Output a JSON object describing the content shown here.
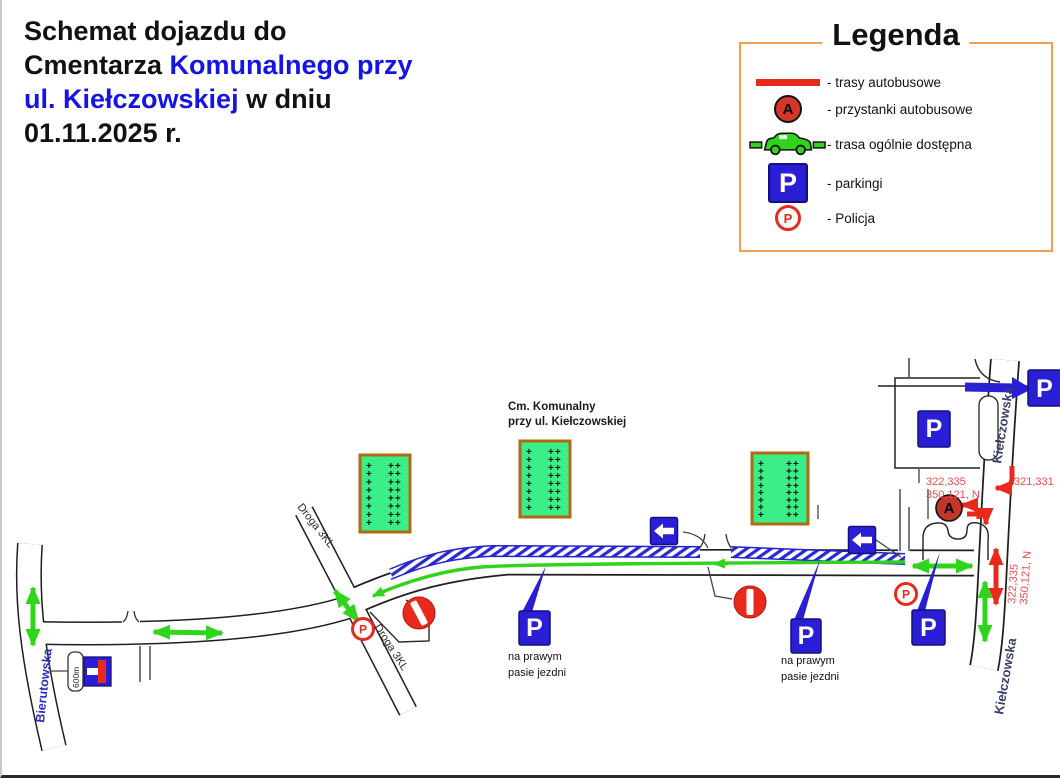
{
  "title": {
    "part1": "Schemat dojazdu do Cmentarza ",
    "part2": "Komunalnego przy ul. Kiełczowskiej",
    "part3": " w dniu  01.11.2025 r."
  },
  "legend": {
    "title": "Legenda",
    "items": [
      {
        "name": "bus-routes",
        "label": "- trasy autobusowe"
      },
      {
        "name": "bus-stops",
        "label": "- przystanki autobusowe"
      },
      {
        "name": "public-route",
        "label": "- trasa ogólnie dostępna"
      },
      {
        "name": "parkings",
        "label": "- parkingi"
      },
      {
        "name": "police",
        "label": "-  Policja"
      }
    ]
  },
  "map": {
    "cemetery": {
      "line1": "Cm. Komunalny",
      "line2": "przy ul. Kiełczowskiej",
      "cross": "+",
      "cross_pair": "++",
      "rows": 8
    },
    "streets": {
      "bierutowska": "Bierutowska",
      "kielczowska": "Kiełczowska",
      "droga3kl": "Droga 3KL"
    },
    "notes": {
      "right_lane_1": "na prawym",
      "right_lane_2": "pasie jezdni",
      "distance": "600m"
    },
    "refs": {
      "r1": "322,335",
      "r2": "350,121, N",
      "r3": "321,331"
    },
    "letters": {
      "parking": "P",
      "bus_stop": "A",
      "police": "P"
    }
  },
  "colors": {
    "title_blue": "#1414e6",
    "sign_blue": "#2a1fd4",
    "route_green": "#31d41c",
    "cemetery_green": "#3bee87",
    "cemetery_border": "#b06a14",
    "red": "#e8291c",
    "legend_border": "#f0a050",
    "ref_red": "#ee4a4a"
  }
}
